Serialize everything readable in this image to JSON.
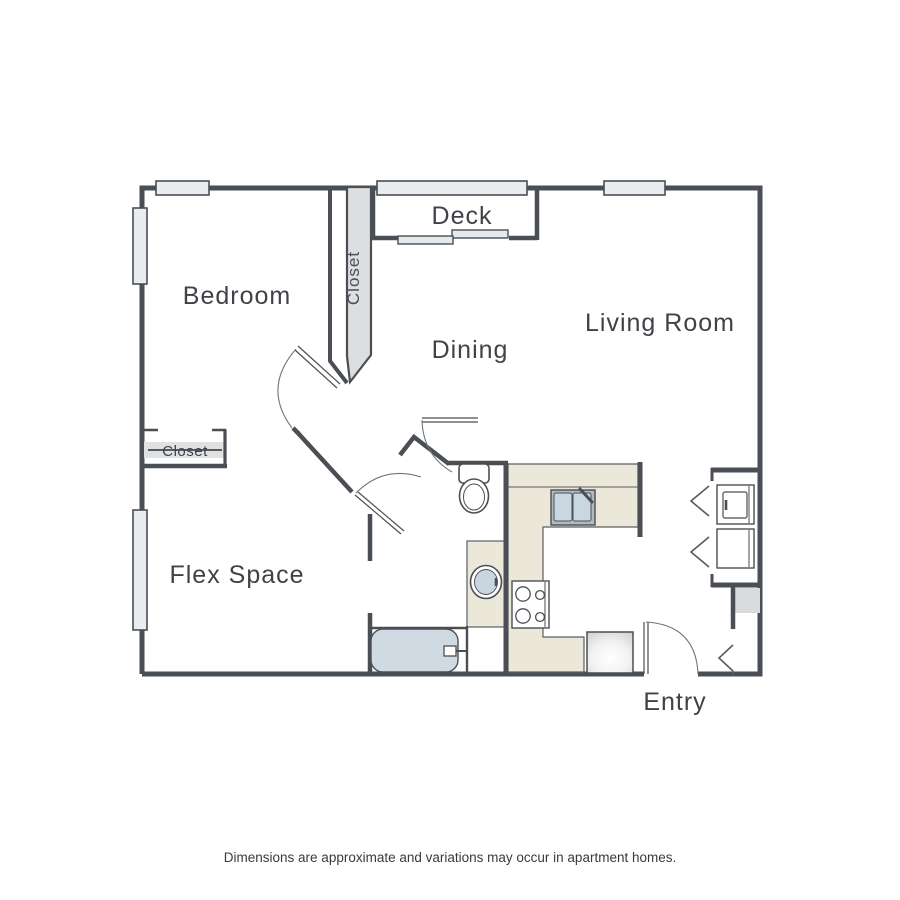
{
  "floor_plan": {
    "rooms": {
      "deck": "Deck",
      "bedroom": "Bedroom",
      "bedroom_closet": "Closet",
      "dining": "Dining",
      "living_room": "Living Room",
      "flex_closet": "Closet",
      "flex_space": "Flex Space",
      "entry": "Entry"
    },
    "disclaimer": "Dimensions are approximate and variations may occur in apartment homes.",
    "colors": {
      "wall": "#4a4f55",
      "window_fill": "#e9edf0",
      "closet_fill": "#dcdee0",
      "counter_fill": "#ece8d9",
      "fixture_blue": "#c9d6df",
      "appliance_gray": "#d9dbdd",
      "label_text": "#3f4347"
    }
  }
}
